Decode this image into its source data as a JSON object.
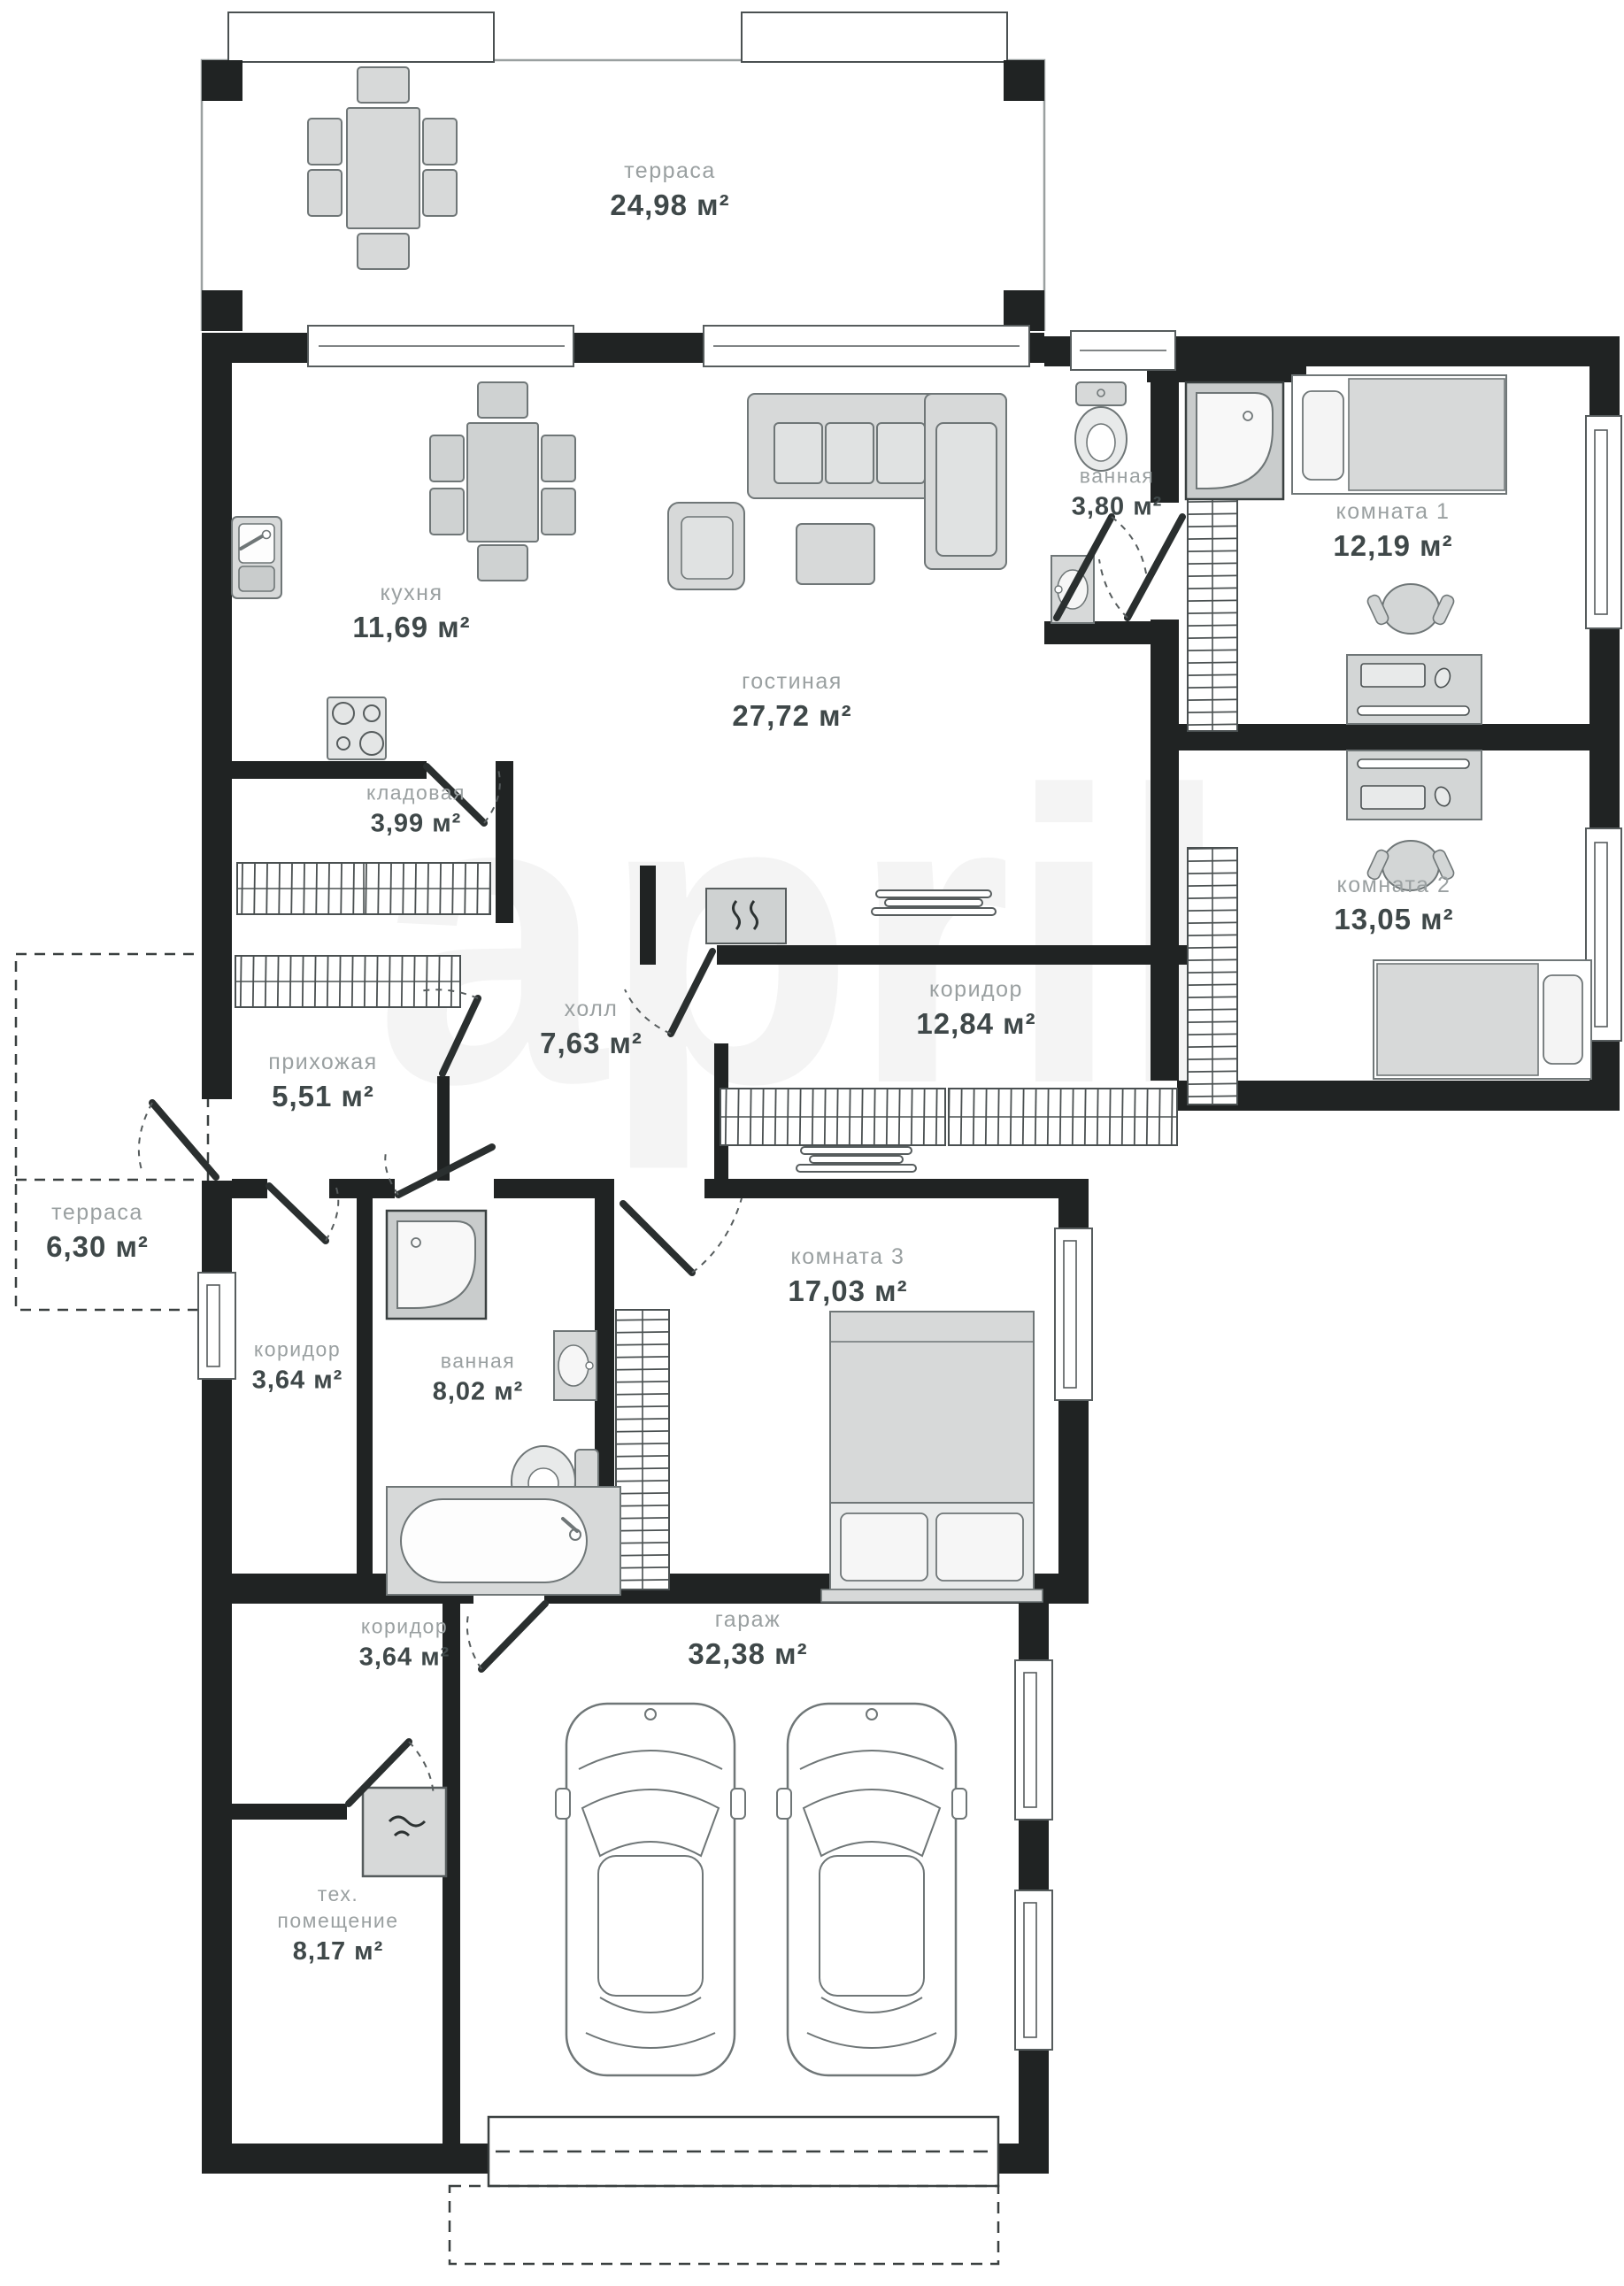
{
  "watermark": "april",
  "rooms": [
    {
      "name": "терраса",
      "area": "24,98 м²"
    },
    {
      "name": "кухня",
      "area": "11,69 м²"
    },
    {
      "name": "гостиная",
      "area": "27,72 м²"
    },
    {
      "name": "ванная",
      "area": "3,80 м²"
    },
    {
      "name": "комната 1",
      "area": "12,19 м²"
    },
    {
      "name": "кладовая",
      "area": "3,99 м²"
    },
    {
      "name": "комната 2",
      "area": "13,05 м²"
    },
    {
      "name": "холл",
      "area": "7,63 м²"
    },
    {
      "name": "коридор",
      "area": "12,84 м²"
    },
    {
      "name": "прихожая",
      "area": "5,51 м²"
    },
    {
      "name": "терраса",
      "area": "6,30 м²"
    },
    {
      "name": "коридор",
      "area": "3,64 м²"
    },
    {
      "name": "ванная",
      "area": "8,02 м²"
    },
    {
      "name": "комната 3",
      "area": "17,03 м²"
    },
    {
      "name": "коридор",
      "area": "3,64 м²"
    },
    {
      "name": "гараж",
      "area": "32,38 м²"
    },
    {
      "name": "тех. помещение",
      "area": "8,17 м²"
    }
  ],
  "colors": {
    "walls": "#202323",
    "furniture_fill": "#d7d9d9",
    "furniture_stroke": "#6f7677",
    "label_name": "#9aa0a1",
    "label_area": "#3f4849",
    "watermark": "#f4f4f4"
  }
}
